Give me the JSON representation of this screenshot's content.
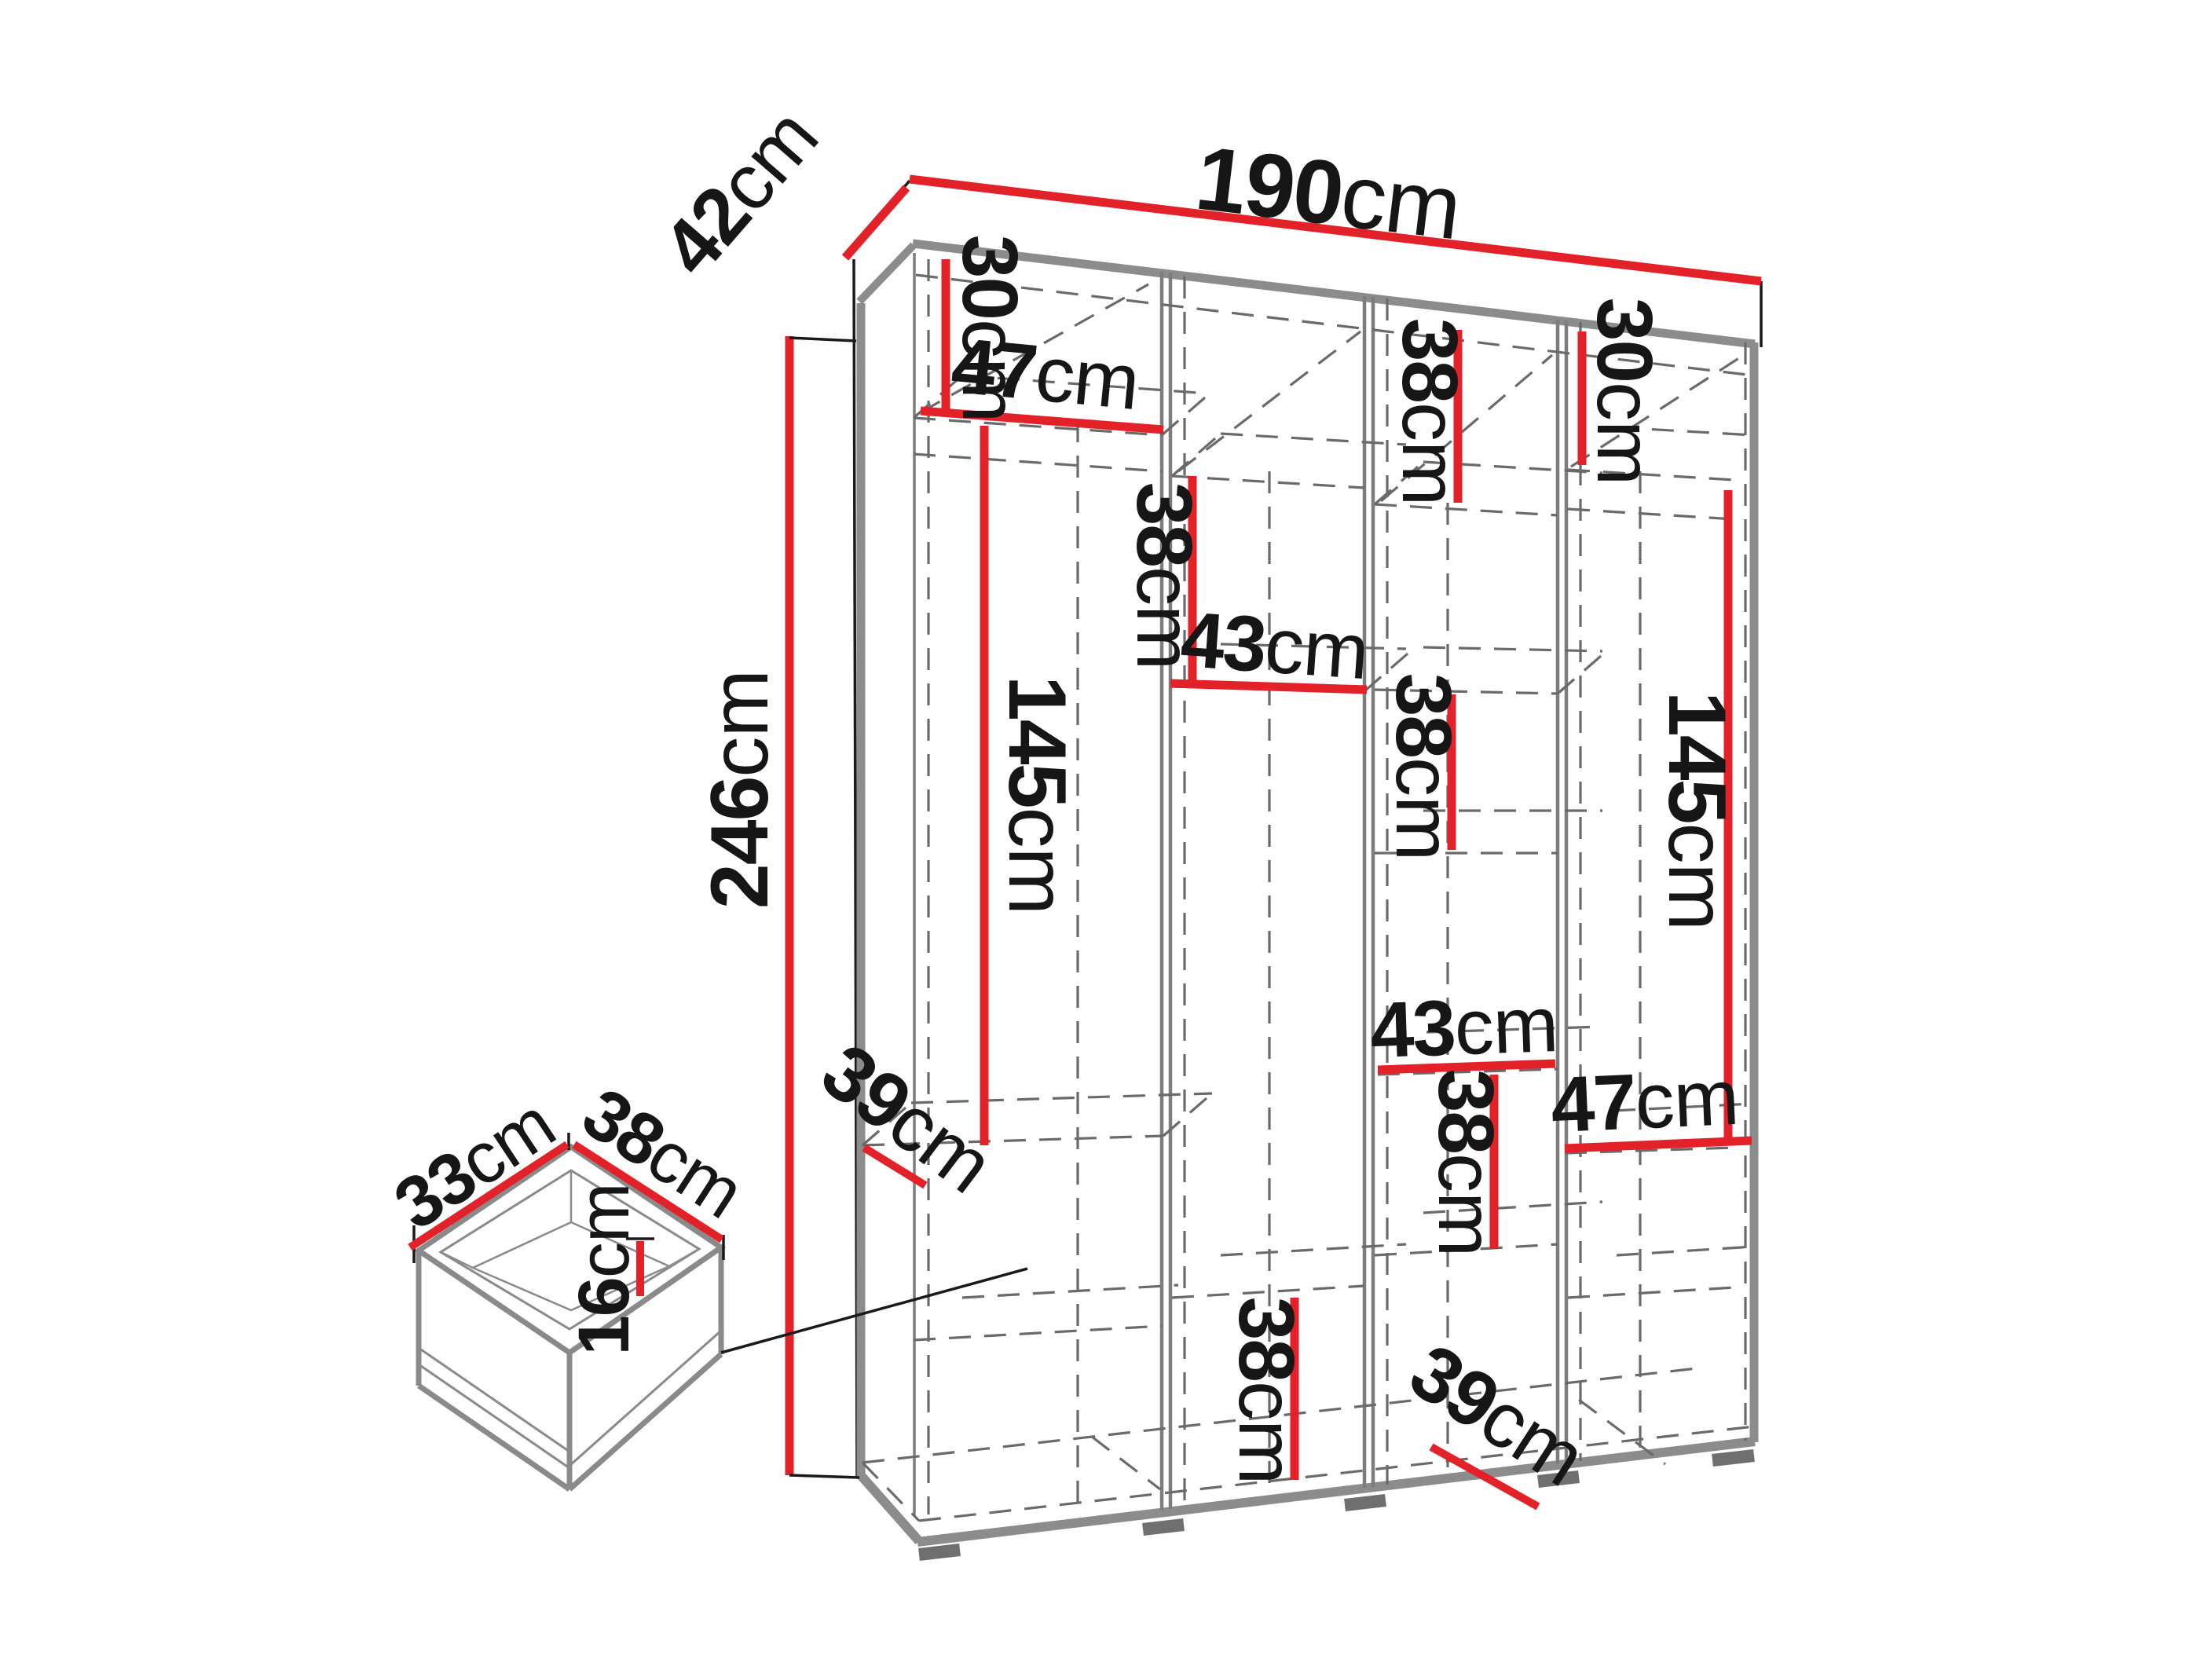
{
  "diagram_title": "wardrobe-dimensions",
  "unit": "cm",
  "colors": {
    "dimension_red": "#e32128",
    "carcass_gray": "#8c8c8c",
    "dashed_gray": "#6a6a6a",
    "text_black": "#161616"
  },
  "wardrobe": {
    "width_cm": 190,
    "depth_cm": 42,
    "height_cm": 246
  },
  "drawer_detail": {
    "depth_cm": 33,
    "width_cm": 38,
    "height_cm": 16
  },
  "labels": [
    {
      "name": "width",
      "value": "190",
      "unit": "cm"
    },
    {
      "name": "depth",
      "value": "42",
      "unit": "cm"
    },
    {
      "name": "height",
      "value": "246",
      "unit": "cm"
    },
    {
      "name": "col1-top",
      "value": "30",
      "unit": "cm"
    },
    {
      "name": "col1-shelf",
      "value": "47",
      "unit": "cm"
    },
    {
      "name": "col1-tall",
      "value": "145",
      "unit": "cm"
    },
    {
      "name": "col1-bottom",
      "value": "39",
      "unit": "cm"
    },
    {
      "name": "col2-top",
      "value": "38",
      "unit": "cm"
    },
    {
      "name": "col2-shelf",
      "value": "43",
      "unit": "cm"
    },
    {
      "name": "col2-bottom",
      "value": "38",
      "unit": "cm"
    },
    {
      "name": "col3-top",
      "value": "38",
      "unit": "cm"
    },
    {
      "name": "col3-mid",
      "value": "38",
      "unit": "cm"
    },
    {
      "name": "col3-shelf",
      "value": "43",
      "unit": "cm"
    },
    {
      "name": "col3-low",
      "value": "38",
      "unit": "cm"
    },
    {
      "name": "col3-bottom",
      "value": "39",
      "unit": "cm"
    },
    {
      "name": "col4-top",
      "value": "30",
      "unit": "cm"
    },
    {
      "name": "col4-tall",
      "value": "145",
      "unit": "cm"
    },
    {
      "name": "col4-shelf",
      "value": "47",
      "unit": "cm"
    },
    {
      "name": "drawer-depth",
      "value": "33",
      "unit": "cm"
    },
    {
      "name": "drawer-width",
      "value": "38",
      "unit": "cm"
    },
    {
      "name": "drawer-height",
      "value": "16",
      "unit": "cm"
    }
  ]
}
